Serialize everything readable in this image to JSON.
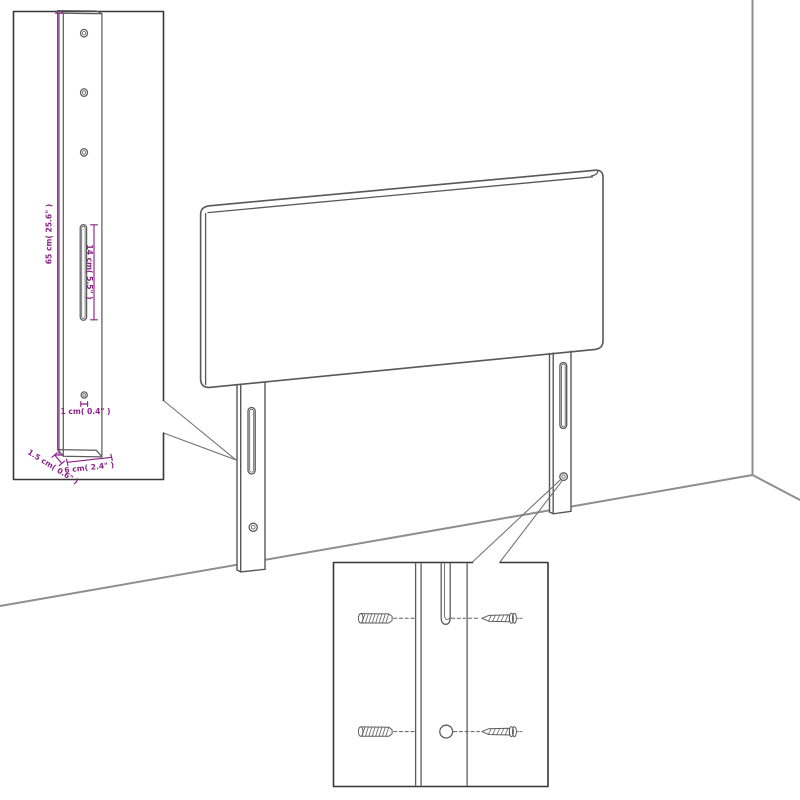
{
  "diagram": {
    "colors": {
      "furniture_line": "#585858",
      "wall_line": "#8e8e8e",
      "callout_border": "#373737",
      "dimension_magenta": "#8E2188"
    },
    "callout_leg": {
      "dim_height": "65 cm( 25.6\" )",
      "dim_slot": "14 cm( 5.5\" )",
      "dim_hole": "1 cm( 0.4\" )",
      "dim_depth": "1.5 cm( 0.6\" )",
      "dim_width": "6 cm( 2.4\" )"
    }
  }
}
